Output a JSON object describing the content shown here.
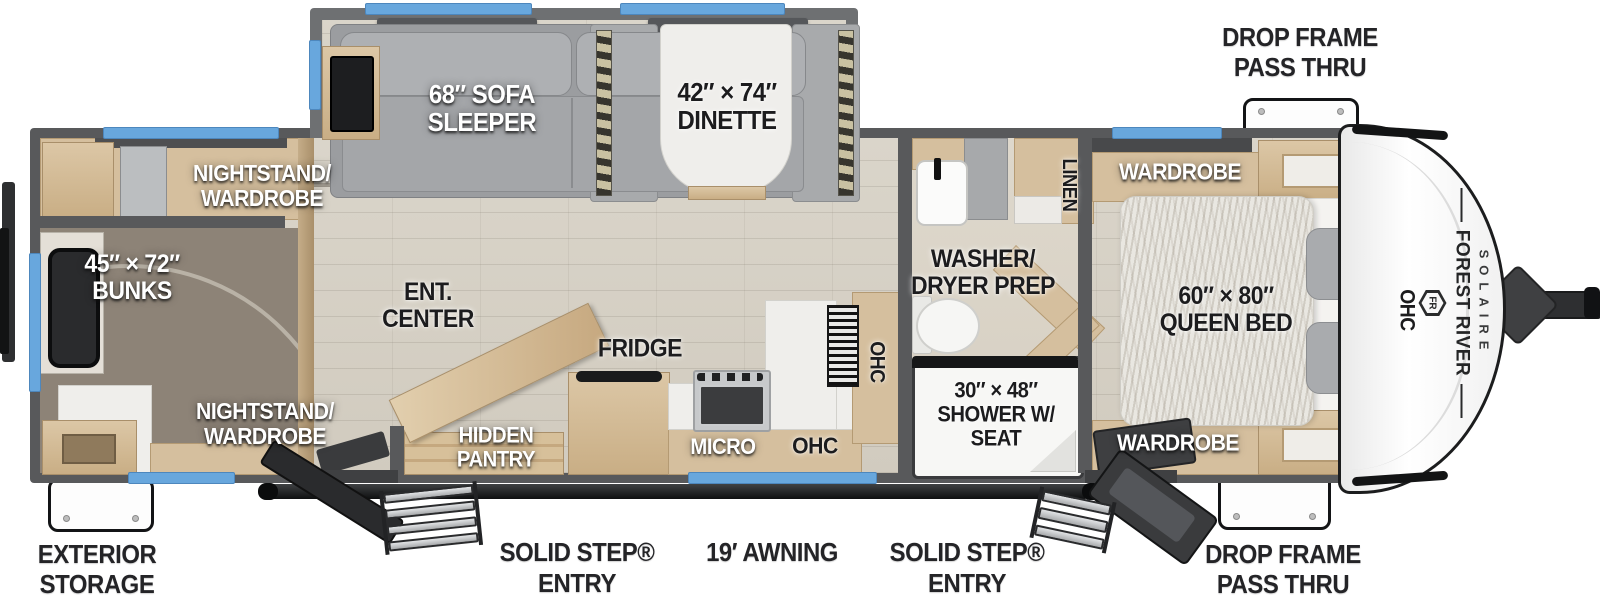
{
  "title": "Travel trailer floor plan",
  "colors": {
    "window_blue": "#68a7dd",
    "wall_gray": "#58595b",
    "slide_wall_gray": "#6e7072",
    "floor_wood": "#d7d2c7",
    "cabinet_wood": "#d5bf9e",
    "carpet": "#8d8377",
    "label_white": "#ffffff",
    "label_black": "#1c1c1e",
    "awning_black": "#141516"
  },
  "exterior": {
    "drop_frame_top": "DROP FRAME\nPASS THRU",
    "drop_frame_bottom": "DROP FRAME\nPASS THRU",
    "exterior_storage": "EXTERIOR\nSTORAGE",
    "solid_step_left": "SOLID STEP®\nENTRY",
    "solid_step_right": "SOLID STEP®\nENTRY",
    "awning": "19′ AWNING"
  },
  "interior": {
    "sofa": "68″ SOFA\nSLEEPER",
    "dinette": "42″ × 74″\nDINETTE",
    "nightstand_top": "NIGHTSTAND/\nWARDROBE",
    "nightstand_bottom": "NIGHTSTAND/\nWARDROBE",
    "bunks": "45″ × 72″\nBUNKS",
    "ent_center": "ENT.\nCENTER",
    "hidden_pantry": "HIDDEN\nPANTRY",
    "fridge": "FRIDGE",
    "micro": "MICRO",
    "ohc_kitchen": "OHC",
    "ohc_kitchen_vertical": "OHC",
    "linen": "LINEN",
    "washer_dryer": "WASHER/\nDRYER PREP",
    "shower": "30″ × 48″\nSHOWER W/\nSEAT",
    "wardrobe_top": "WARDROBE",
    "wardrobe_bottom": "WARDROBE",
    "queen_bed": "60″ × 80″\nQUEEN BED",
    "ohc_bed": "OHC"
  },
  "brand": {
    "maker": "FOREST RIVER",
    "model": "SOLAIRE",
    "logo_monogram": "FR"
  }
}
